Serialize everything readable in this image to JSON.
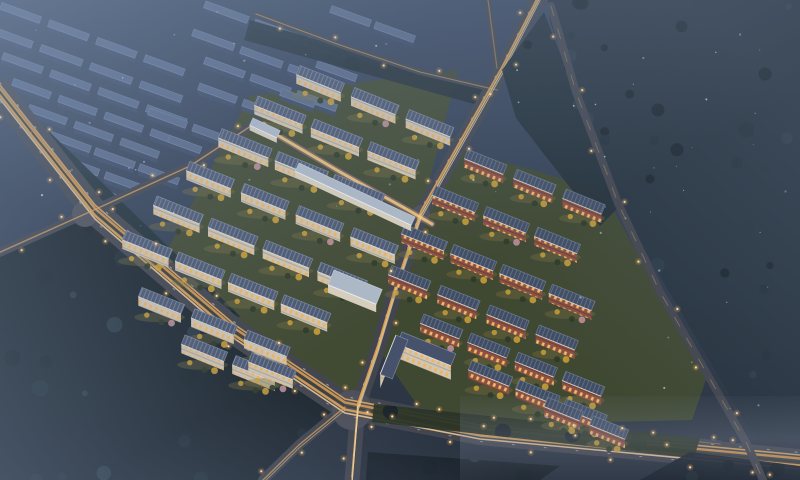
{
  "scene": {
    "title": "Aerial night rendering of residential development",
    "width": 800,
    "height": 480,
    "description": "Dusk aerial view of a master-planned residential development: two illuminated low-rise clusters flanking a central avenue, a highway interchange with amber light trails, a hazy unlit industrial estate to the upper left and dark forest to the right"
  },
  "palette": {
    "sky_top": "#3a4860",
    "sky_mid": "#344155",
    "sky_bot": "#2a3340",
    "road": "#42454e",
    "road_pave": "#4e505a",
    "lamp_core": "#ffeecb",
    "green_dark": "#414a33",
    "green_dark2": "#3f4831",
    "lawn_glow": "#7c7442",
    "tree_gold": "#cfa238",
    "tree_pink": "#c793a0",
    "tree_green": "#2e3a28",
    "forest_dark": "#19232a",
    "forest_mid": "#223039",
    "forest_blue": "#2e3c48",
    "speck": "#cfe0f2",
    "wall_white": "#cfc6b4",
    "wall_brick": "#8c5144",
    "window_warm": "#f2b25c",
    "roof_white": "#4d586f",
    "roof_stripe": "#6e7d9a",
    "roof_brick": "#414d63",
    "roof_brick_stripe": "#5d6c85",
    "unlit_roof": "#5b6c8c",
    "unlit_wall": "#3c4a66",
    "unlit_edge": "#7285a8",
    "canopy_roof": "#aeb9c7",
    "canopy_wall": "#d8cfbd",
    "canopy_edge": "#cdd6e2"
  },
  "roads": [
    {
      "name": "main-highway",
      "points": [
        [
          0,
          92
        ],
        [
          95,
          212
        ],
        [
          235,
          332
        ],
        [
          345,
          406
        ],
        [
          480,
          432
        ],
        [
          800,
          462
        ]
      ],
      "width": 26,
      "lampStep": 40,
      "streaks": [
        {
          "dy": -9.5,
          "w": 1,
          "color": "#efeff5",
          "op": 0.5,
          "dash": "2 26"
        },
        {
          "dy": -7,
          "w": 1.6,
          "color": "#e8ae62",
          "op": 0.85
        },
        {
          "dy": -3.5,
          "w": 2.4,
          "color": "#d99a4e",
          "op": 0.9
        },
        {
          "dy": 0,
          "w": 1.4,
          "color": "#3c3e30",
          "op": 0.95
        },
        {
          "dy": 3.5,
          "w": 2.4,
          "color": "#e2a556",
          "op": 0.9
        },
        {
          "dy": 7,
          "w": 1.6,
          "color": "#f6cf96",
          "op": 0.85
        },
        {
          "dy": 9.5,
          "w": 1,
          "color": "#e8e8f0",
          "op": 0.45,
          "dash": "2 30"
        }
      ]
    },
    {
      "name": "central-avenue",
      "points": [
        [
          540,
          -4
        ],
        [
          502,
          70
        ],
        [
          458,
          148
        ],
        [
          421,
          214
        ],
        [
          396,
          288
        ],
        [
          378,
          348
        ],
        [
          358,
          406
        ],
        [
          352,
          480
        ]
      ],
      "width": 15,
      "lampStep": 48,
      "streaks": [
        {
          "dy": -3,
          "w": 1.8,
          "color": "#e2a556",
          "op": 0.9
        },
        {
          "dy": 1,
          "w": 1.4,
          "color": "#f4c87e",
          "op": 0.85
        },
        {
          "dy": 4.5,
          "w": 1,
          "color": "#f8e3bb",
          "op": 0.65
        },
        {
          "dy": -5.5,
          "w": 0.9,
          "color": "#ededf3",
          "op": 0.4,
          "dash": "2 22"
        }
      ]
    },
    {
      "name": "west-access-road",
      "points": [
        [
          -4,
          254
        ],
        [
          85,
          214
        ],
        [
          190,
          166
        ],
        [
          257,
          122
        ]
      ],
      "width": 9,
      "lampStep": 50,
      "streaks": [
        {
          "dy": 0,
          "w": 1.4,
          "color": "#d9a35c",
          "op": 0.75
        }
      ]
    },
    {
      "name": "north-boundary-road",
      "points": [
        [
          256,
          14
        ],
        [
          340,
          45
        ],
        [
          420,
          72
        ],
        [
          497,
          90
        ]
      ],
      "width": 6,
      "lampStep": 55,
      "streaks": [
        {
          "dy": 0,
          "w": 1.1,
          "color": "#d8a860",
          "op": 0.6
        }
      ]
    },
    {
      "name": "avenue-north-spur",
      "points": [
        [
          497,
          68
        ],
        [
          488,
          0
        ]
      ],
      "width": 7,
      "lampStep": 0,
      "streaks": [
        {
          "dy": 0,
          "w": 1.2,
          "color": "#caa05e",
          "op": 0.5
        }
      ]
    },
    {
      "name": "southwest-branch",
      "points": [
        [
          345,
          407
        ],
        [
          300,
          444
        ],
        [
          263,
          480
        ]
      ],
      "width": 10,
      "lampStep": 42,
      "streaks": [
        {
          "dy": 0,
          "w": 1.4,
          "color": "#dda45a",
          "op": 0.75
        },
        {
          "dy": 3,
          "w": 1,
          "color": "#f0c488",
          "op": 0.6
        }
      ]
    },
    {
      "name": "frontage-road",
      "points": [
        [
          370,
          408
        ],
        [
          520,
          424
        ],
        [
          720,
          444
        ]
      ],
      "width": 7,
      "lampStep": 46,
      "streaks": [
        {
          "dy": 0,
          "w": 1,
          "color": "#c89c5e",
          "op": 0.5
        }
      ]
    },
    {
      "name": "commercial-spine-street",
      "points": [
        [
          255,
          122
        ],
        [
          340,
          172
        ],
        [
          408,
          210
        ],
        [
          432,
          224
        ]
      ],
      "width": 8,
      "lampStep": 0,
      "streaks": [
        {
          "dy": 0,
          "w": 6,
          "color": "#f5b75f",
          "op": 0.3
        },
        {
          "dy": 0,
          "w": 3,
          "color": "#ffcf84",
          "op": 0.8
        }
      ]
    },
    {
      "name": "east-boundary-road",
      "points": [
        [
          551,
          6
        ],
        [
          576,
          92
        ],
        [
          618,
          203
        ],
        [
          659,
          290
        ],
        [
          706,
          372
        ],
        [
          747,
          444
        ],
        [
          763,
          480
        ]
      ],
      "width": 8,
      "lampStep": 60,
      "over": true,
      "streaks": [
        {
          "dy": 0,
          "w": 1,
          "color": "#b9935e",
          "op": 0.5,
          "dash": "10 14"
        }
      ]
    }
  ],
  "intersections": [
    [
      85,
      214,
      13
    ],
    [
      352,
      410,
      20
    ],
    [
      421,
      214,
      9
    ]
  ],
  "ground_areas": [
    {
      "name": "left-cluster-ground",
      "points": [
        [
          250,
          96
        ],
        [
          458,
          70
        ],
        [
          421,
          214
        ],
        [
          378,
          350
        ],
        [
          360,
          402
        ],
        [
          148,
          286
        ]
      ],
      "fill": "#414a33"
    },
    {
      "name": "right-cluster-ground",
      "points": [
        [
          462,
          150
        ],
        [
          602,
          190
        ],
        [
          664,
          300
        ],
        [
          708,
          374
        ],
        [
          692,
          420
        ],
        [
          432,
          426
        ],
        [
          380,
          352
        ],
        [
          422,
          216
        ]
      ],
      "fill": "#3f4831"
    }
  ],
  "tree_areas_pre": [
    {
      "name": "southwest-forest",
      "points": [
        [
          0,
          256
        ],
        [
          86,
          216
        ],
        [
          344,
          402
        ],
        [
          302,
          446
        ],
        [
          264,
          480
        ],
        [
          0,
          480
        ]
      ],
      "base": "#1d272e",
      "density": 26
    },
    {
      "name": "highway-north-strip",
      "points": [
        [
          0,
          84
        ],
        [
          240,
          316
        ],
        [
          224,
          332
        ],
        [
          0,
          102
        ]
      ],
      "base": "#223038",
      "density": 10
    },
    {
      "name": "north-edge-strip",
      "points": [
        [
          250,
          20
        ],
        [
          495,
          92
        ],
        [
          488,
          108
        ],
        [
          244,
          40
        ]
      ],
      "base": "#25313a",
      "density": 8
    }
  ],
  "tree_areas_post": [
    {
      "name": "east-forest",
      "points": [
        [
          548,
          0
        ],
        [
          800,
          0
        ],
        [
          800,
          440
        ],
        [
          756,
          440
        ],
        [
          620,
          208
        ],
        [
          574,
          92
        ],
        [
          550,
          22
        ]
      ],
      "base": "#27333e",
      "density": 60
    },
    {
      "name": "mid-tree-strip",
      "points": [
        [
          502,
          70
        ],
        [
          544,
          12
        ],
        [
          578,
          100
        ],
        [
          618,
          208
        ],
        [
          600,
          226
        ],
        [
          516,
          118
        ]
      ],
      "base": "#232f39",
      "density": 12
    },
    {
      "name": "south-buffer-strip",
      "points": [
        [
          374,
          404
        ],
        [
          700,
          438
        ],
        [
          694,
          458
        ],
        [
          372,
          422
        ]
      ],
      "base": "#2b3527",
      "density": 14
    },
    {
      "name": "far-south-strip",
      "points": [
        [
          690,
          452
        ],
        [
          800,
          466
        ],
        [
          800,
          480
        ],
        [
          640,
          480
        ]
      ],
      "base": "#1c2530",
      "density": 6
    },
    {
      "name": "south-strip-left",
      "points": [
        [
          368,
          452
        ],
        [
          560,
          466
        ],
        [
          540,
          480
        ],
        [
          366,
          480
        ]
      ],
      "base": "#1b242c",
      "density": 5
    }
  ],
  "clusters": {
    "left": {
      "style": "white",
      "angle": 22,
      "gap": 9,
      "rows": [
        {
          "x": 300,
          "y": 66,
          "n": 3,
          "len": 50
        },
        {
          "x": 258,
          "y": 96,
          "n": 3,
          "len": 52
        },
        {
          "x": 222,
          "y": 128,
          "n": 3,
          "len": 52
        },
        {
          "x": 190,
          "y": 162,
          "n": 4,
          "len": 50
        },
        {
          "x": 157,
          "y": 196,
          "n": 4,
          "len": 50
        },
        {
          "x": 126,
          "y": 230,
          "n": 4,
          "len": 48
        },
        {
          "x": 142,
          "y": 288,
          "n": 3,
          "len": 48
        },
        {
          "x": 185,
          "y": 335,
          "n": 2,
          "len": 46
        },
        {
          "x": 252,
          "y": 352,
          "n": 1,
          "len": 46
        }
      ]
    },
    "right": {
      "style": "brick",
      "angle": 22,
      "gap": 9,
      "rows": [
        {
          "x": 468,
          "y": 150,
          "n": 3,
          "len": 44
        },
        {
          "x": 436,
          "y": 186,
          "n": 3,
          "len": 46
        },
        {
          "x": 405,
          "y": 224,
          "n": 4,
          "len": 44
        },
        {
          "x": 392,
          "y": 266,
          "n": 4,
          "len": 44
        },
        {
          "x": 424,
          "y": 314,
          "n": 4,
          "len": 42
        },
        {
          "x": 472,
          "y": 360,
          "n": 3,
          "len": 42
        },
        {
          "x": 548,
          "y": 398,
          "n": 2,
          "len": 40
        }
      ]
    },
    "unlit": {
      "style": "unlit",
      "angle": 20,
      "gap": 7,
      "rows": [
        {
          "x": 2,
          "y": 3,
          "n": 4,
          "len": 44
        },
        {
          "x": 206,
          "y": 1,
          "n": 3,
          "len": 46
        },
        {
          "x": 332,
          "y": 5,
          "n": 2,
          "len": 40
        },
        {
          "x": -8,
          "y": 27,
          "n": 4,
          "len": 46
        },
        {
          "x": 194,
          "y": 29,
          "n": 3,
          "len": 44
        },
        {
          "x": 310,
          "y": 32,
          "n": 2,
          "len": 34
        },
        {
          "x": 4,
          "y": 53,
          "n": 4,
          "len": 44
        },
        {
          "x": 206,
          "y": 57,
          "n": 3,
          "len": 42
        },
        {
          "x": 318,
          "y": 60,
          "n": 1,
          "len": 40
        },
        {
          "x": 14,
          "y": 79,
          "n": 4,
          "len": 42
        },
        {
          "x": 200,
          "y": 83,
          "n": 2,
          "len": 40
        },
        {
          "x": 282,
          "y": 88,
          "n": 1,
          "len": 34
        },
        {
          "x": 30,
          "y": 105,
          "n": 3,
          "len": 42
        },
        {
          "x": 150,
          "y": 108,
          "n": 2,
          "len": 40
        },
        {
          "x": 52,
          "y": 131,
          "n": 3,
          "len": 40
        },
        {
          "x": 170,
          "y": 136,
          "n": 1,
          "len": 36
        },
        {
          "x": 66,
          "y": 157,
          "n": 2,
          "len": 36
        },
        {
          "x": 84,
          "y": 182,
          "n": 1,
          "len": 32
        }
      ]
    }
  },
  "landmarks": [
    {
      "name": "commercial-spine-canopy",
      "x": 299,
      "y": 163,
      "angle": 25,
      "len": 128,
      "depth": 9,
      "h": 6,
      "style": "canopy"
    },
    {
      "name": "entry-canopy",
      "x": 253,
      "y": 118,
      "angle": 25,
      "len": 30,
      "depth": 8,
      "h": 5,
      "style": "canopy"
    },
    {
      "name": "kindergarten-block",
      "x": 334,
      "y": 270,
      "angle": 22,
      "len": 52,
      "depth": 16,
      "h": 8,
      "style": "canopy"
    },
    {
      "name": "office-block-main",
      "x": 402,
      "y": 332,
      "angle": 22,
      "len": 58,
      "depth": 13,
      "h": 14,
      "style": "whiteTall"
    },
    {
      "name": "office-block-wing",
      "x": 408,
      "y": 340,
      "angle": 112,
      "len": 42,
      "depth": 13,
      "h": 14,
      "style": "whiteTall"
    }
  ],
  "effects": {
    "speck_count": 64
  }
}
